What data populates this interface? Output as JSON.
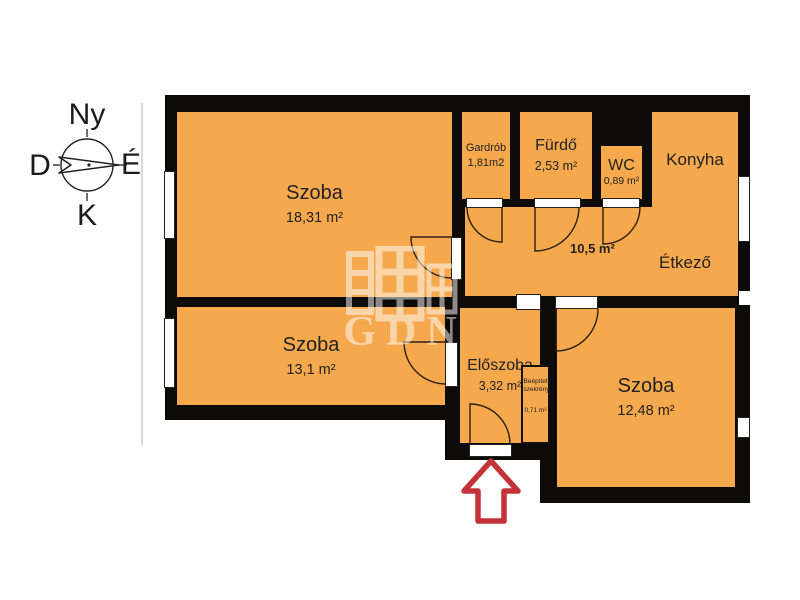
{
  "compass": {
    "top": "Ny",
    "left": "D",
    "right": "É",
    "bottom": "K"
  },
  "watermark": {
    "text": "GDN"
  },
  "rooms": {
    "szoba_large": {
      "name": "Szoba",
      "area": "18,31 m²"
    },
    "gardrob": {
      "name": "Gardrób",
      "area": "1,81m2"
    },
    "furdo": {
      "name": "Fürdő",
      "area": "2,53 m²"
    },
    "wc": {
      "name": "WC",
      "area": "0,89 m²"
    },
    "konyha": {
      "name": "Konyha"
    },
    "etkezo": {
      "name": "Étkező"
    },
    "kozlekedo": {
      "area": "10,5 m²"
    },
    "szoba_mid": {
      "name": "Szoba",
      "area": "13,1 m²"
    },
    "eloszoba": {
      "name": "Előszoba",
      "area": "3,32 m²"
    },
    "szekreny": {
      "name": "Beépített szekrény",
      "area": "0,71 m²"
    },
    "szoba_small": {
      "name": "Szoba",
      "area": "12,48 m²"
    }
  },
  "colors": {
    "room": "#f5a84c",
    "wall": "#0d0b08",
    "arrow": "#c43339"
  }
}
